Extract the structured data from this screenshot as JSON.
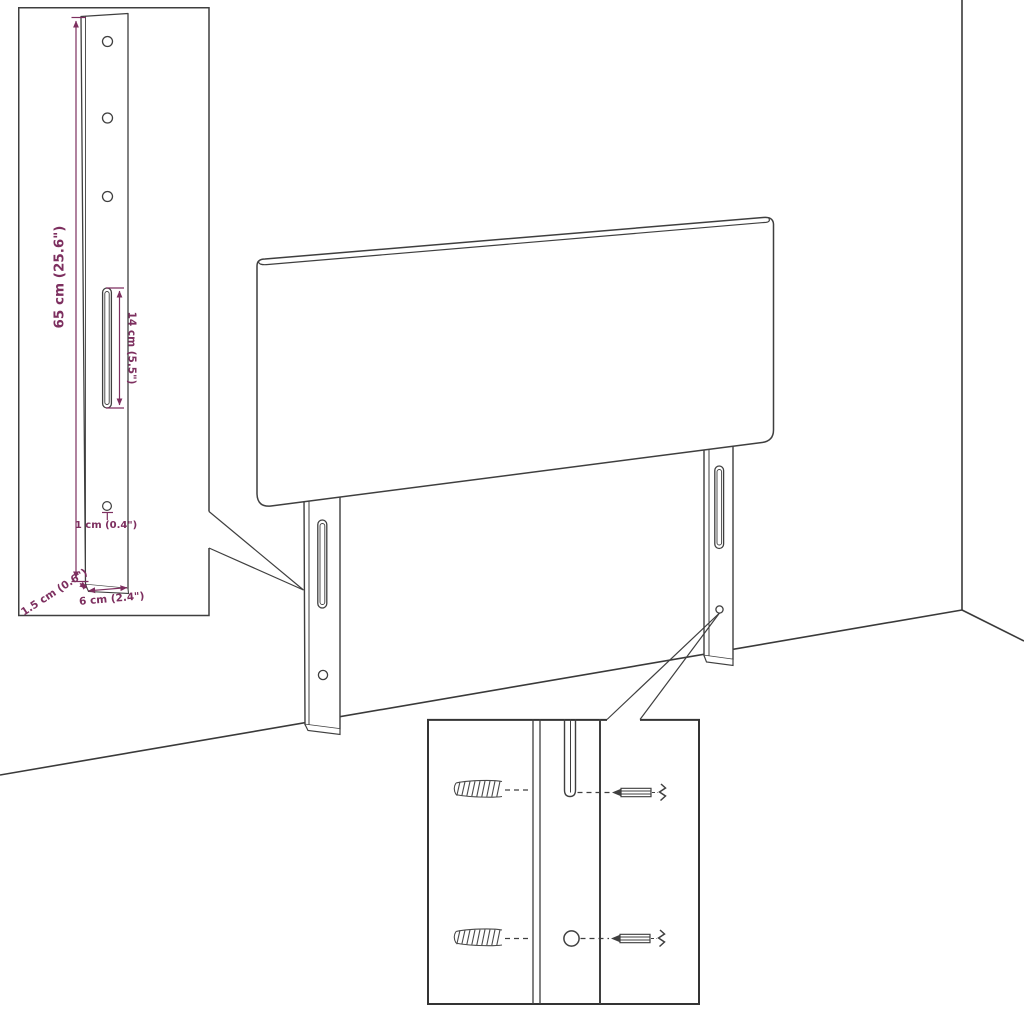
{
  "illustration": {
    "kind": "product-dimension-diagram",
    "subject": "upholstered headboard with two mounting legs, leg detail inset and wall-fixing hardware inset",
    "colors": {
      "background": "#ffffff",
      "drawing_line": "#3f3f3f",
      "inset_border": "#343434",
      "dimension": "#7d2f5f"
    },
    "labels": {
      "leg_height": "65 cm (25.6\")",
      "slot_length": "14 cm (5.5\")",
      "hole_diameter": "1 cm (0.4\")",
      "leg_depth": "1.5 cm (0.6\")",
      "leg_width": "6 cm (2.4\")"
    }
  }
}
